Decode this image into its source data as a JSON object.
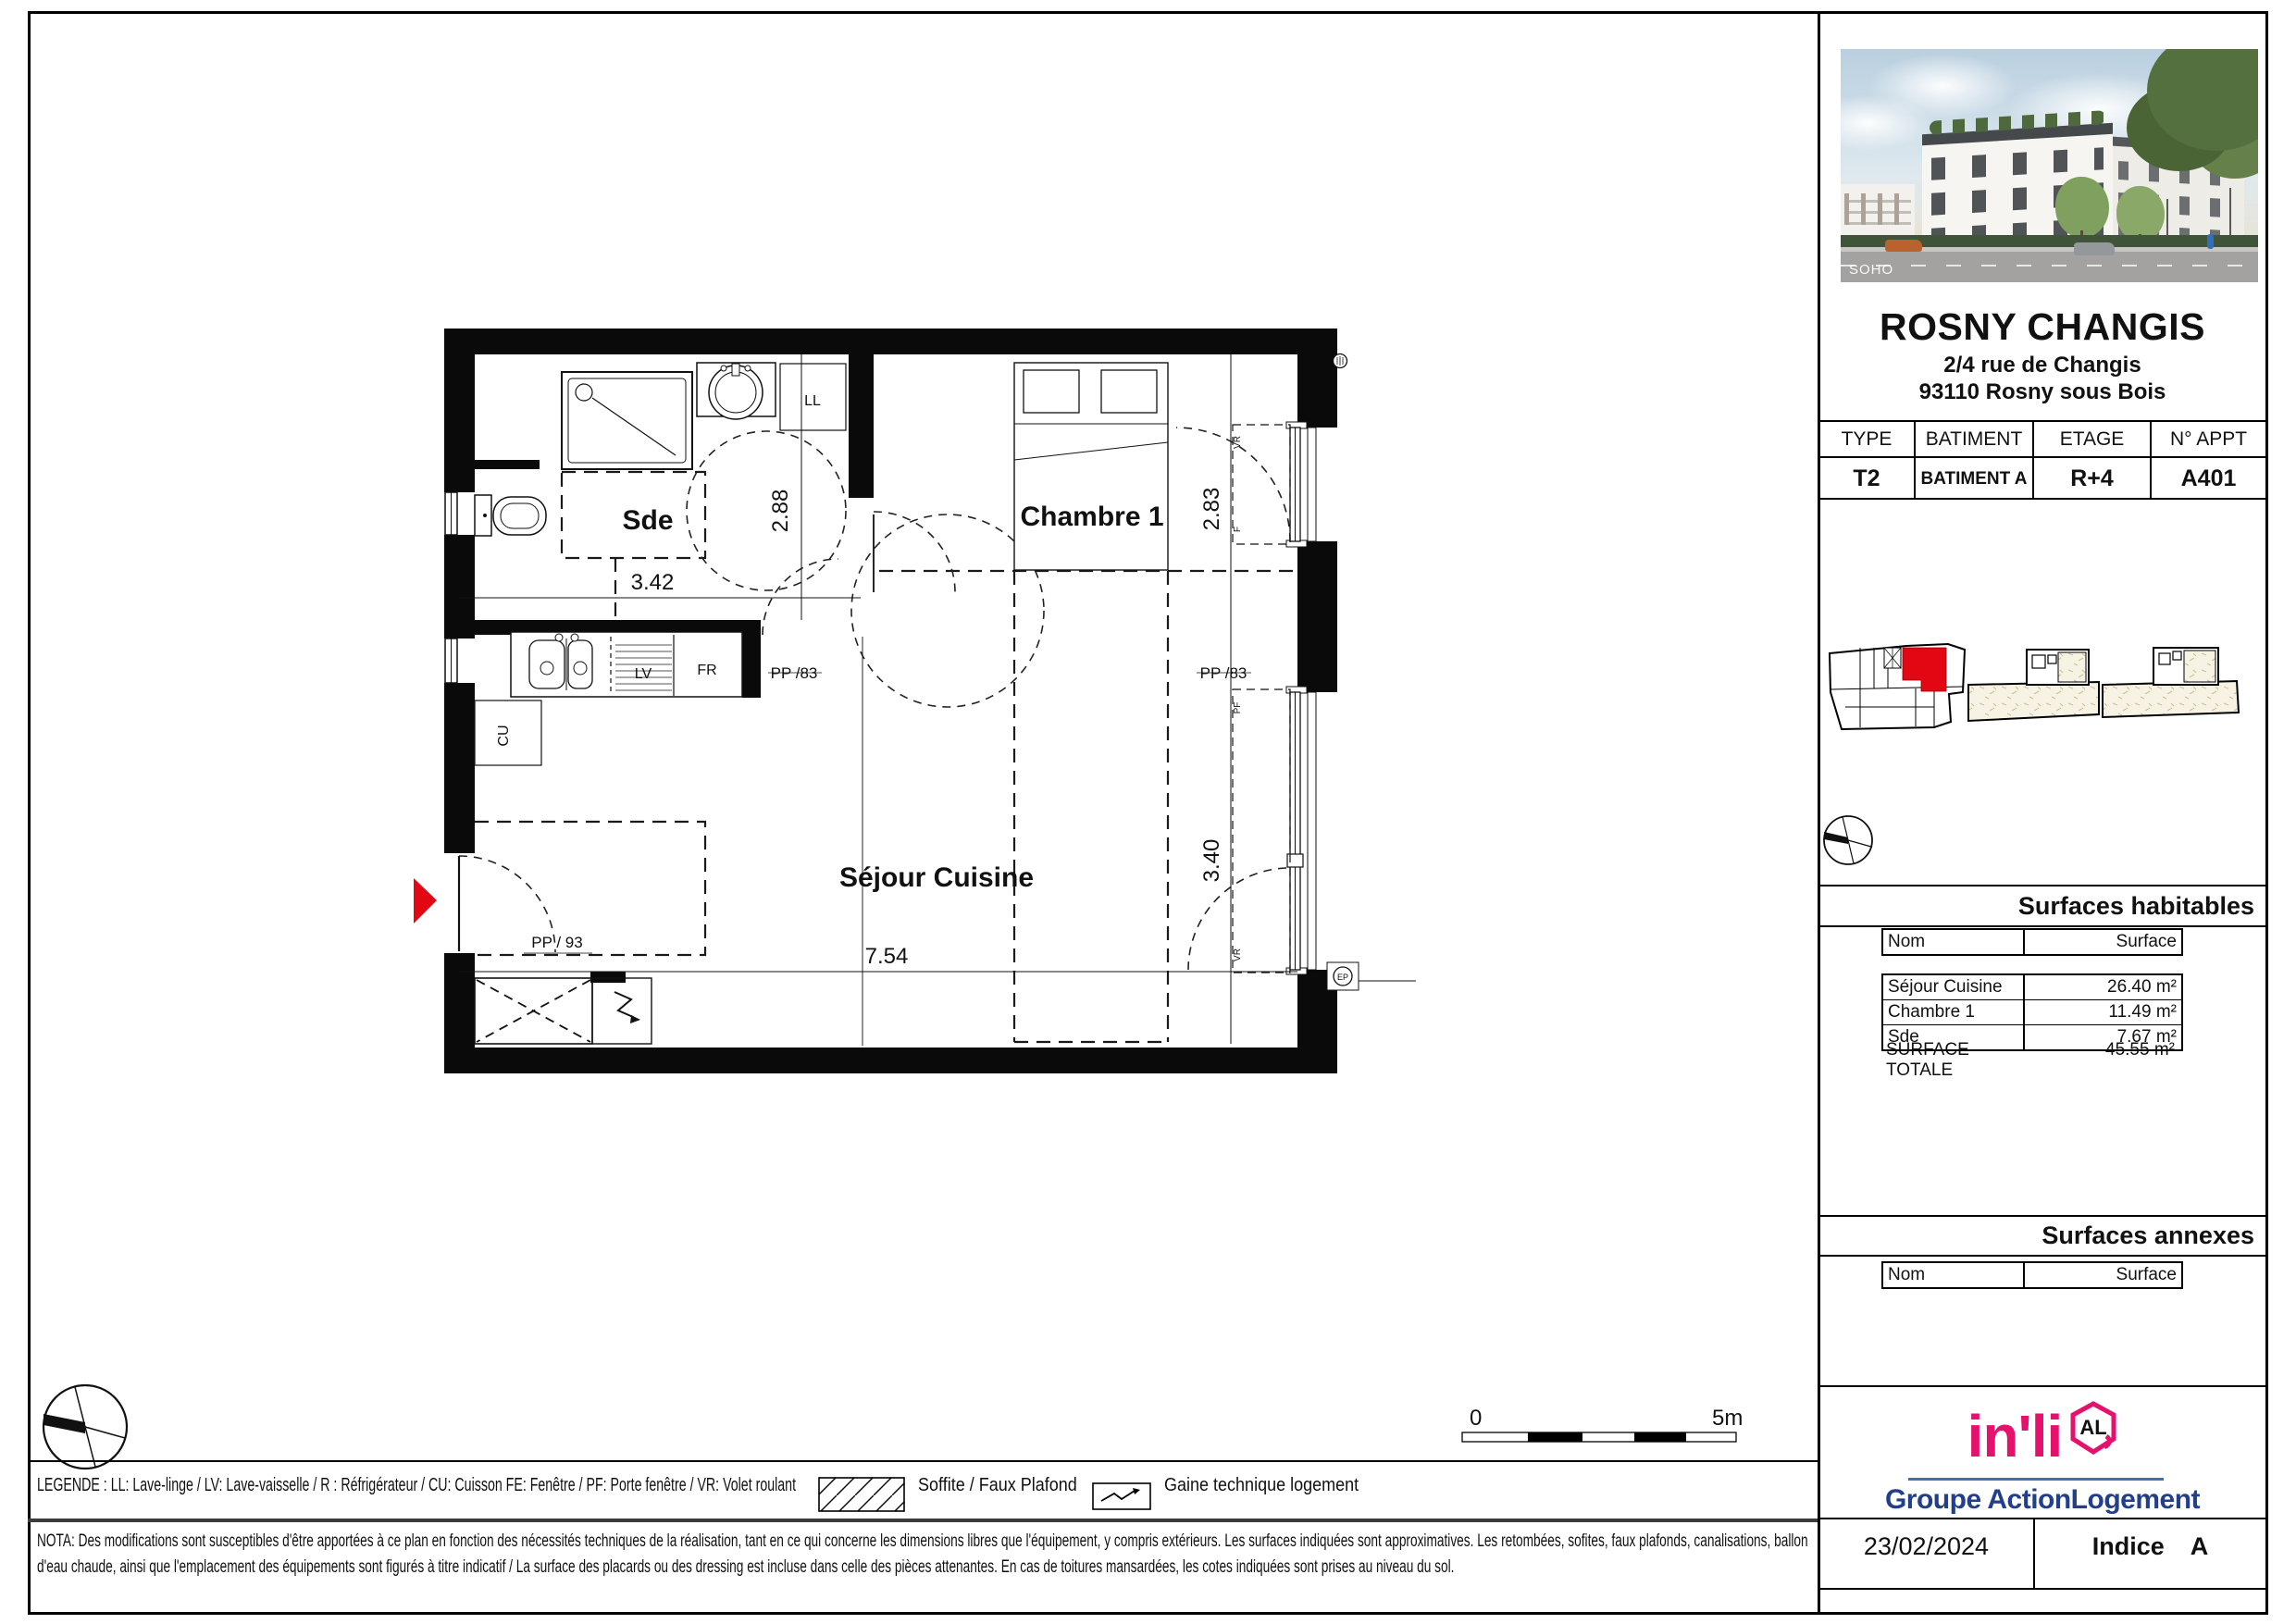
{
  "header": {
    "title": "ROSNY CHANGIS",
    "address1": "2/4 rue de Changis",
    "address2": "93110 Rosny sous Bois"
  },
  "photo": {
    "watermark": "SOHO"
  },
  "info_table": {
    "headers": [
      "TYPE",
      "BATIMENT",
      "ETAGE",
      "N° APPT"
    ],
    "values": [
      "T2",
      "BATIMENT A",
      "R+4",
      "A401"
    ]
  },
  "surfaces_habitables": {
    "title": "Surfaces habitables",
    "columns": {
      "nom": "Nom",
      "surface": "Surface"
    },
    "rows": [
      {
        "nom": "Séjour Cuisine",
        "surface": "26.40 m²"
      },
      {
        "nom": "Chambre 1",
        "surface": "11.49 m²"
      },
      {
        "nom": "Sde",
        "surface": "7.67 m²"
      }
    ],
    "total": {
      "nom": "SURFACE TOTALE",
      "surface": "45.55 m²"
    }
  },
  "surfaces_annexes": {
    "title": "Surfaces annexes",
    "columns": {
      "nom": "Nom",
      "surface": "Surface"
    }
  },
  "brand": {
    "name": "in'li",
    "badge": "AL",
    "group": "Groupe ActionLogement",
    "pink": "#e5116c",
    "navy": "#233e8b",
    "line_blue": "#3d73b4"
  },
  "footer": {
    "date": "23/02/2024",
    "indice_label": "Indice",
    "indice_value": "A"
  },
  "legend": {
    "text": "LEGENDE : LL: Lave-linge / LV: Lave-vaisselle / R : Réfrigérateur / CU: Cuisson FE: Fenêtre / PF: Porte fenêtre / VR: Volet roulant",
    "soffite_label": "Soffite / Faux Plafond",
    "gaine_label": "Gaine technique logement"
  },
  "nota": "NOTA: Des modifications sont susceptibles d'être apportées à ce plan en fonction des nécessités techniques de la réalisation, tant en ce qui concerne les dimensions libres que l'équipement, y compris extérieurs. Les surfaces indiquées sont approximatives. Les retombées, sofites, faux plafonds, canalisations, ballon d'eau chaude, ainsi que l'emplacement des équipements sont figurés à titre indicatif / La surface des placards ou des dressing est incluse dans celle des pièces attenantes. En cas de toitures mansardées, les cotes indiquées sont prises au niveau du sol.",
  "plan": {
    "rooms": {
      "sde": "Sde",
      "chambre1": "Chambre 1",
      "sejour": "Séjour Cuisine"
    },
    "dims": {
      "w_sde": "3.42",
      "h_sde": "2.88",
      "h_chambre": "2.83",
      "h_window": "3.40",
      "w_sejour": "7.54"
    },
    "doors": {
      "pp83": "PP /83",
      "pp93": "PP / 93"
    },
    "labels": {
      "ll": "LL",
      "lv": "LV",
      "fr": "FR",
      "cu": "CU",
      "pf": "PF",
      "vr": "VR",
      "f": "F",
      "ep": "EP"
    },
    "scale": {
      "start": "0",
      "end": "5m"
    },
    "highlight_color": "#e30613"
  }
}
